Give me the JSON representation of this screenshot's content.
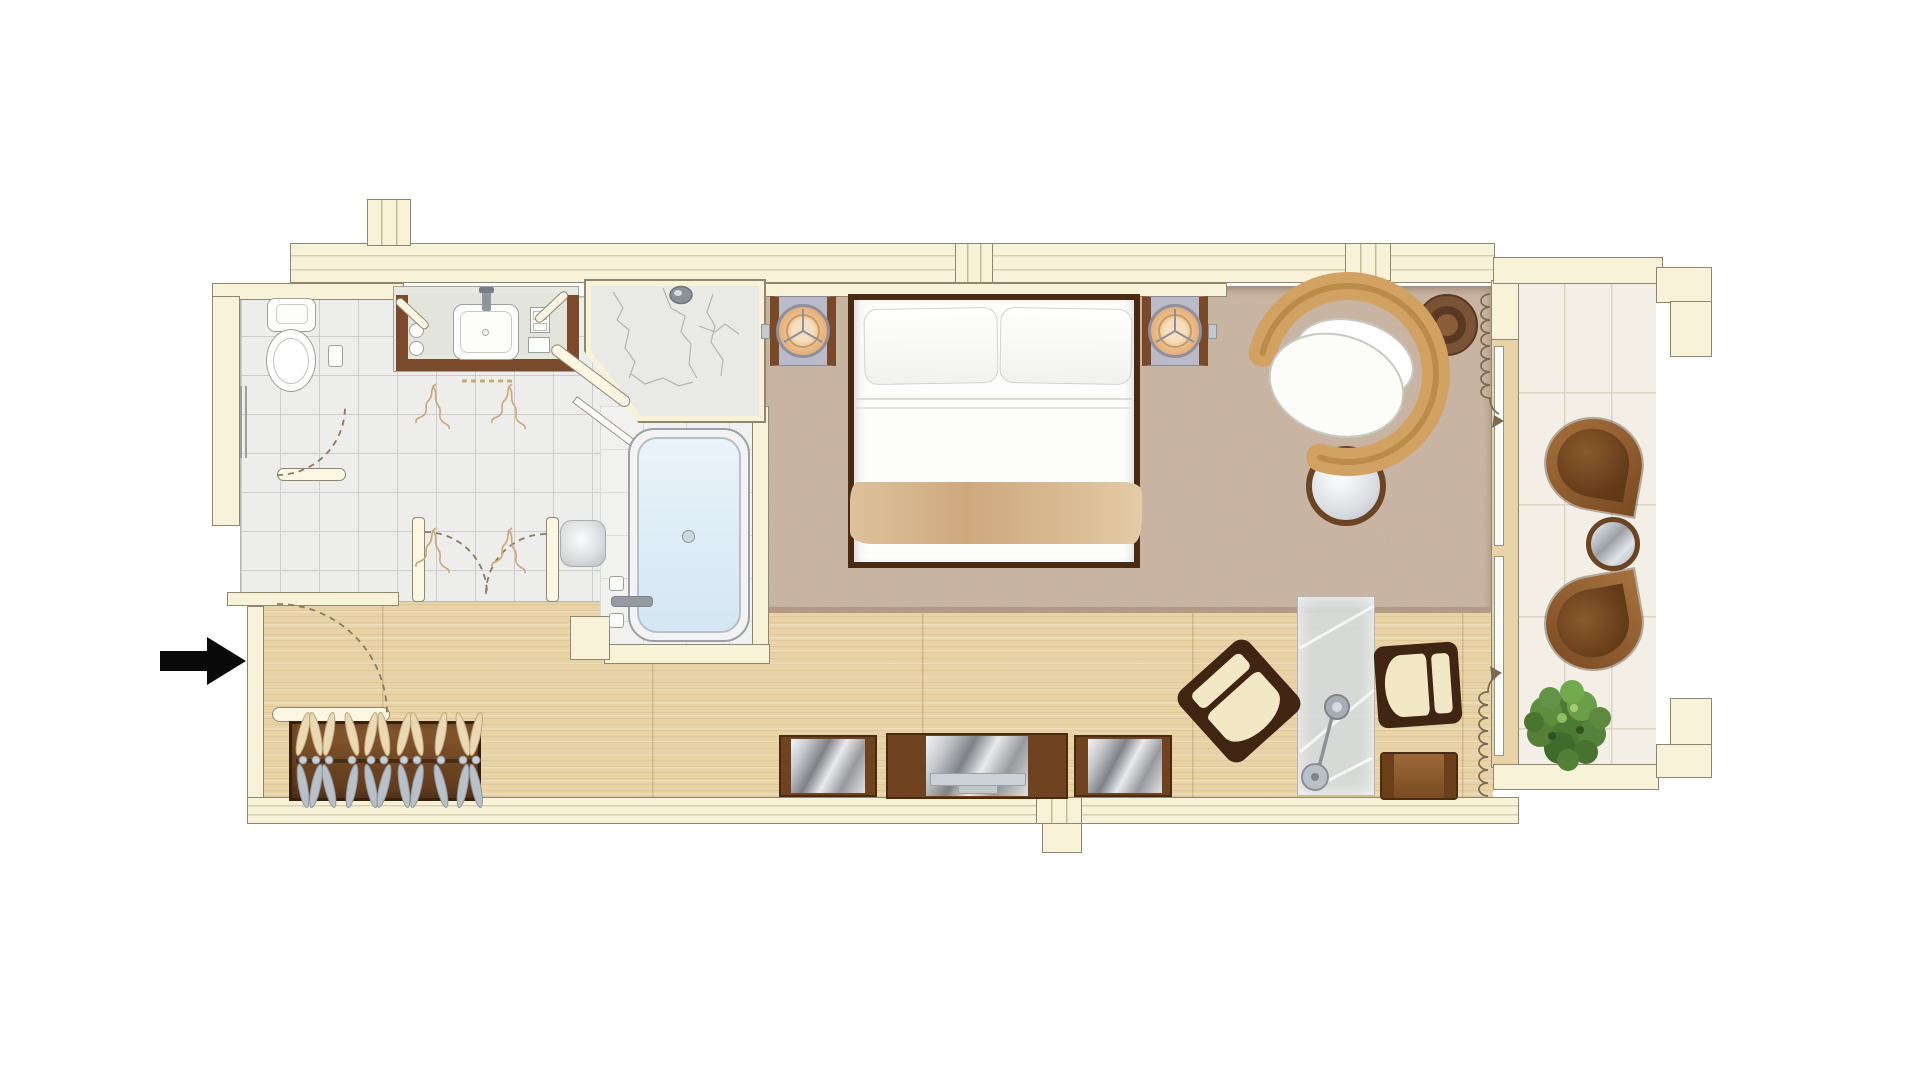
{
  "meta": {
    "title": "Hotel guest room floor plan (top-down architectural drawing, no text labels)",
    "view": "top-down",
    "visible_text": "none"
  },
  "palette": {
    "wall": "#f8f3d8",
    "wall-line": "#8e8872",
    "wood": "#e8d3a6",
    "tile": "#ededec",
    "grout": "#cdcec9",
    "btile": "#f3eee6",
    "bgrout": "#ddd4c4",
    "carpet": "#cdb9a8",
    "carpet-edge": "#b39c88",
    "dark-wood": "#4a2b11",
    "brown": "#7a4a26",
    "rattan": "#d2a263",
    "cream": "#f2e8c6",
    "metal": "#aab0b5",
    "water": "#ddecf7",
    "doodle": "#c9a878",
    "swing": "#8a7a5f",
    "arrow": "#0a0a0a",
    "plant-green": "#4c7a33"
  },
  "rooms": {
    "bathroom": {
      "label": "Bathroom",
      "fixtures": [
        "toilet",
        "toilet-paper-holder",
        "towel-bar",
        "vanity-with-sink",
        "glasses x2",
        "amenity-trays",
        "walk-in-shower",
        "shower-head",
        "bathtub",
        "tub-faucet",
        "bath-stool",
        "double-swing-door",
        "decorative-towel-doodles"
      ]
    },
    "bedroom": {
      "label": "Bedroom / living area",
      "furniture": [
        "double-bed",
        "pillow x2",
        "headboard-ledge",
        "nightstand-with-round-lamp x2",
        "light-switch x2",
        "round-rattan-armchair",
        "round-ottoman",
        "round-side-table",
        "glass-desk",
        "desk-lamp",
        "desk-chair x2",
        "luggage-bench",
        "tv-cabinet-with-tv",
        "media-console x2",
        "window-curtain x2"
      ]
    },
    "entry": {
      "label": "Entry corridor",
      "furniture": [
        "entry-door-with-swing",
        "wardrobe-with-hangers"
      ]
    },
    "balcony": {
      "label": "Balcony / terrace",
      "furniture": [
        "petal-lounge-chair x2",
        "round-metal-table",
        "potted-plant"
      ]
    }
  },
  "annotations": {
    "entry_arrow_direction": "right",
    "door_swings": 4,
    "window_curtains": 2,
    "hanger_count": 11,
    "bed_count": 1,
    "lamp_count": 3
  }
}
